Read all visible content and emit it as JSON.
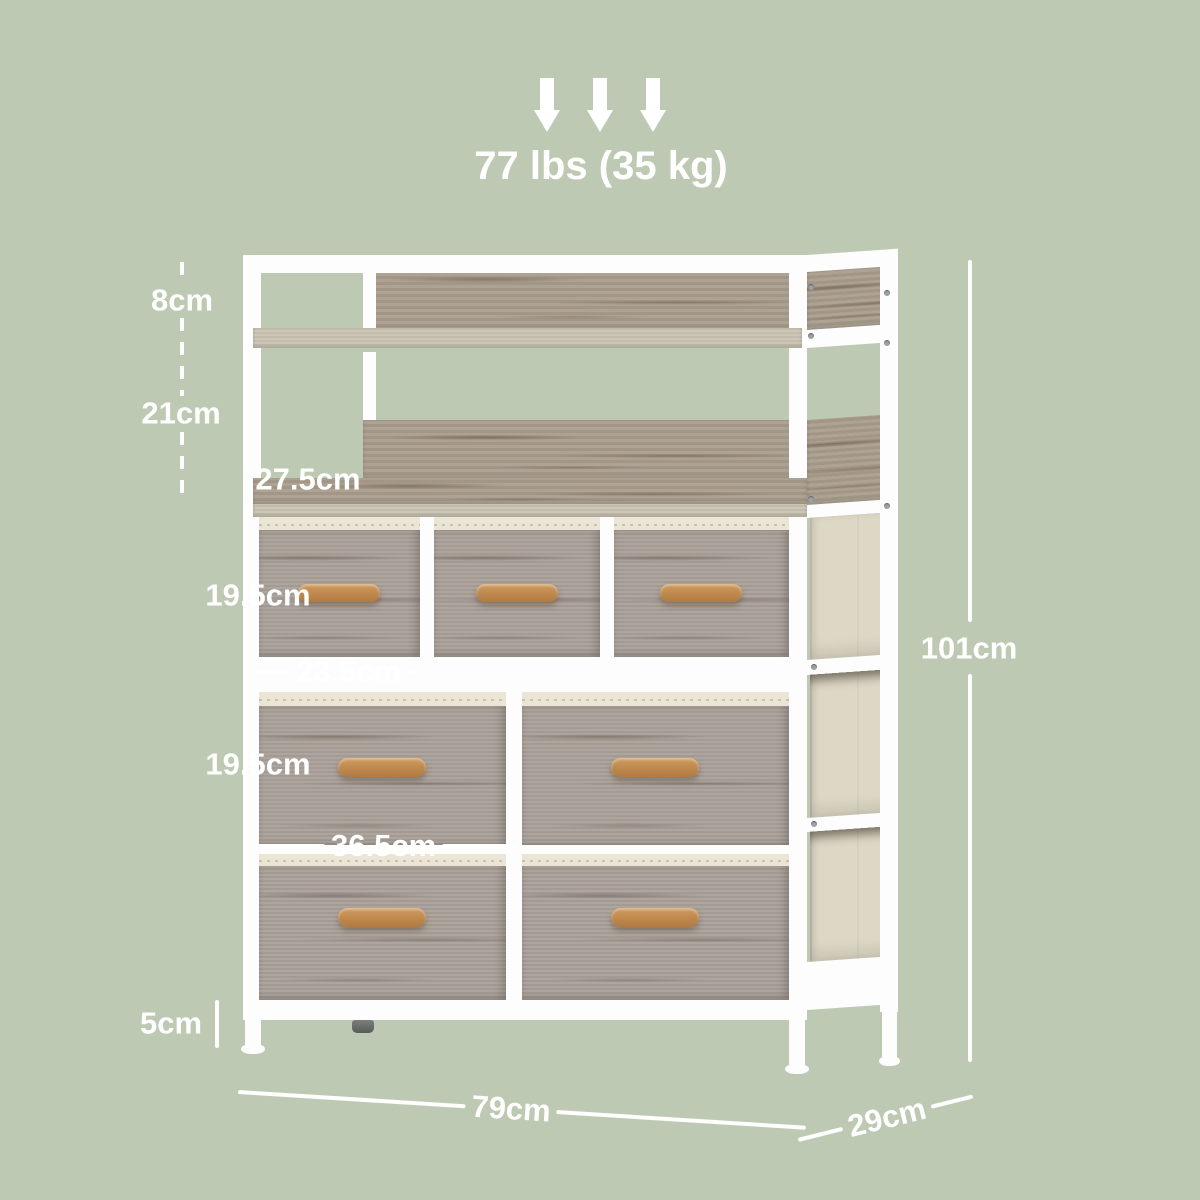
{
  "diagram": {
    "weight_capacity": "77 lbs (35 kg)",
    "dimensions": {
      "top_back_height": "8cm",
      "shelf_clearance": "21cm",
      "shelf_depth": "27.5cm",
      "small_drawer_height": "19.5cm",
      "small_drawer_width": "23.5cm",
      "large_drawer_height": "19.5cm",
      "large_drawer_width": "36.5cm",
      "foot_height": "5cm",
      "overall_height": "101cm",
      "overall_width": "79cm",
      "overall_depth": "29cm"
    },
    "colors": {
      "background": "#bec9b3",
      "frame_white": "#fdfdfd",
      "wood": "#a99d8d",
      "wood_light": "#c9c2b1",
      "drawer_fabric": "#a9a098",
      "bin_fabric": "#ddd7c5",
      "binding": "#eae5d5",
      "handle_wood": "#c0894f",
      "annotation_text": "#ffffff"
    },
    "icons": {
      "load_arrows": "down-arrow"
    }
  }
}
